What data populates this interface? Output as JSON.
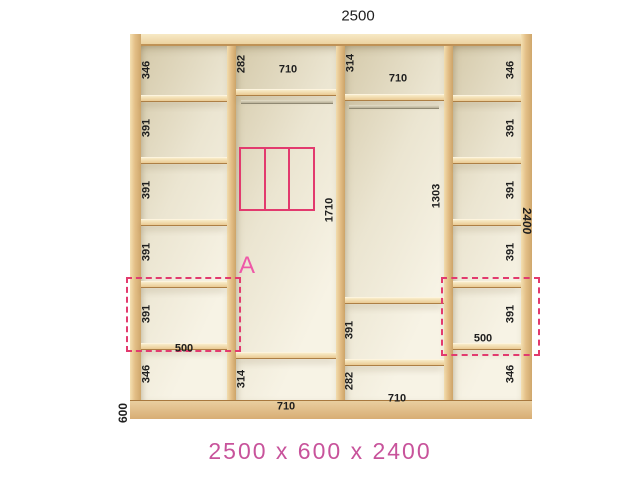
{
  "diagram": {
    "type": "wardrobe-interior-dimension-diagram",
    "caption": "2500 x 600 x 2400",
    "marker": "A",
    "dims": {
      "width": "2500",
      "depth": "600",
      "height": "2400"
    },
    "columns": [
      {
        "name": "left-shelf-tower",
        "sections": [
          "346",
          "391",
          "391",
          "391",
          "391",
          "346"
        ],
        "width_label": "500"
      },
      {
        "name": "left-hanging-section",
        "top": "282",
        "top_width": "710",
        "middle": "1710",
        "bottom": "314",
        "bottom_width": "710"
      },
      {
        "name": "right-hanging-section",
        "top": "314",
        "top_width": "710",
        "middle": "1303",
        "lower": "391",
        "bottom": "282",
        "bottom_width": "710"
      },
      {
        "name": "right-shelf-tower",
        "sections": [
          "346",
          "391",
          "391",
          "391",
          "391",
          "346"
        ],
        "width_label": "500"
      }
    ],
    "icons": [
      "drawer-unit-symbol",
      "hanging-rod",
      "highlight-dashed-box"
    ],
    "colors": {
      "wood": "#e3bf87",
      "wood_light": "#f7e9c6",
      "wood_dark": "#cfa76c",
      "interior": "#f3eedd",
      "accent_dashed": "#e23a6e",
      "marker": "#ee59a8",
      "caption": "#c8539b",
      "label": "#1e1e1e",
      "background": "#ffffff"
    }
  }
}
